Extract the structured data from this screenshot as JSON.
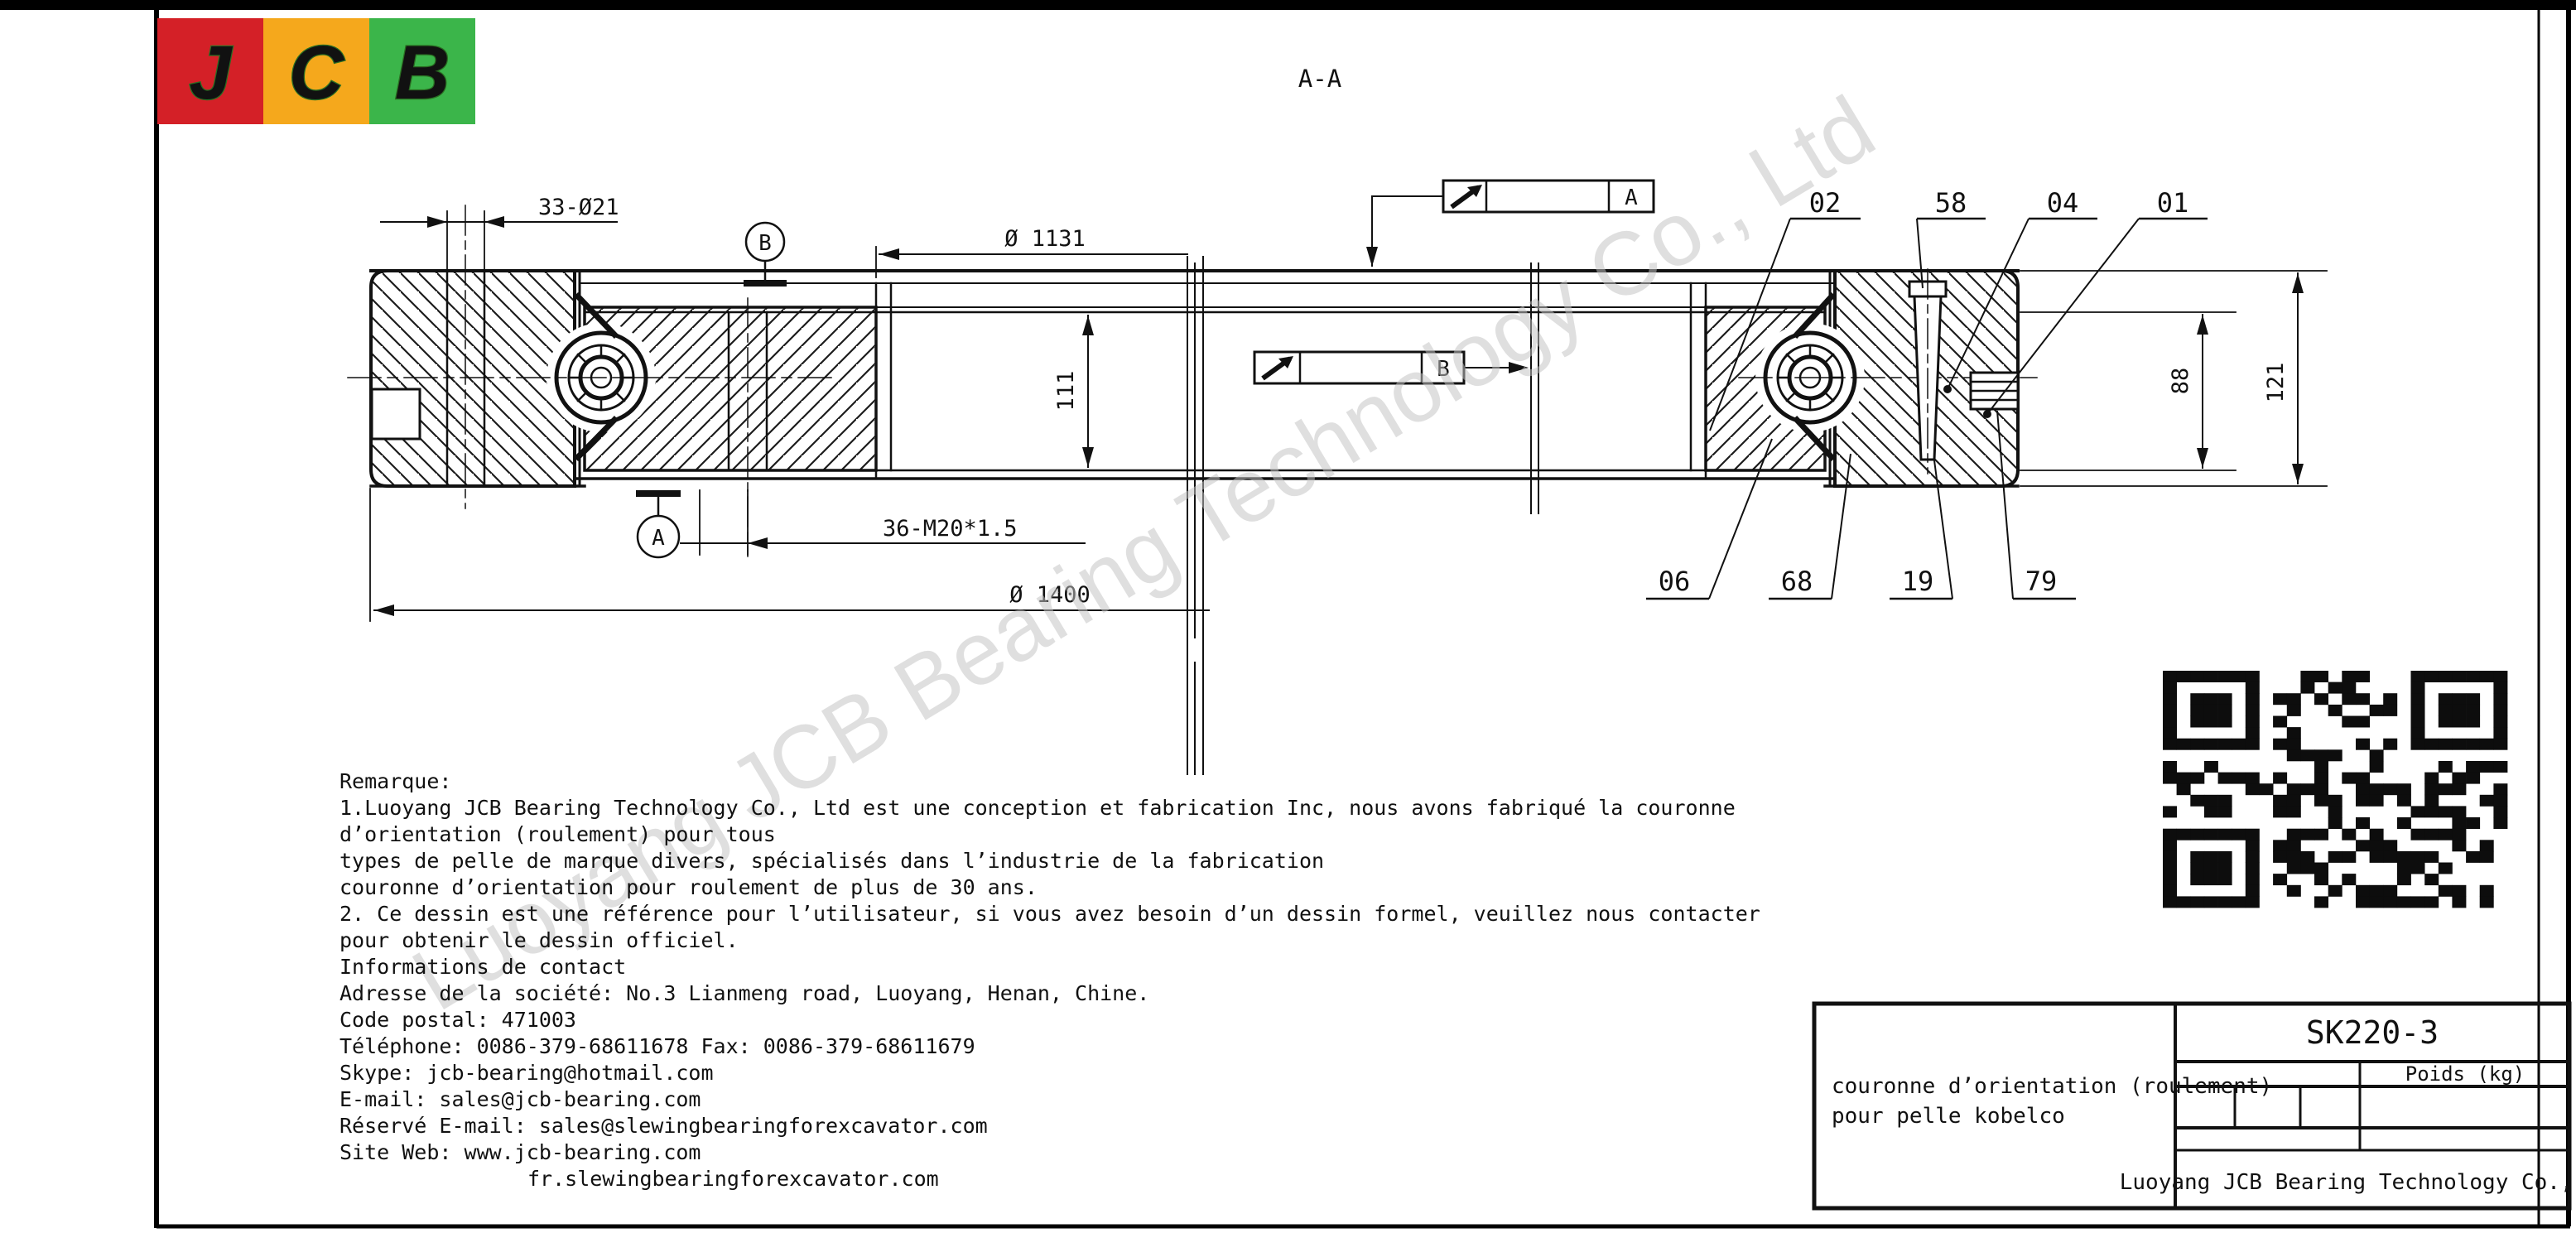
{
  "page": {
    "section_label": "A-A"
  },
  "logo": {
    "letters": [
      "J",
      "C",
      "B"
    ],
    "colors": {
      "red": "#d42027",
      "orange": "#f5a81c",
      "green": "#3bb54a",
      "letter": "#f2eb0a"
    }
  },
  "watermark": "Luoyang JCB Bearing Technology Co., Ltd",
  "drawing": {
    "dims": {
      "bolt_pattern_top": "33-Ø21",
      "bore_diameter": "Ø 1131",
      "bore_height": "111",
      "bolt_pattern_bottom": "36-M20*1.5",
      "outer_diameter": "Ø 1400",
      "inner_ring_height": "88",
      "total_height": "121"
    },
    "datums": {
      "a": "A",
      "b": "B"
    },
    "callouts_top": [
      "02",
      "58",
      "04",
      "01"
    ],
    "callouts_bottom": [
      "06",
      "68",
      "19",
      "79"
    ]
  },
  "notes": {
    "lines": [
      "Remarque:",
      "1.Luoyang JCB Bearing Technology Co., Ltd est une conception et fabrication Inc, nous avons fabriqué la couronne",
      "d’orientation (roulement) pour tous",
      "types de pelle de marque divers, spécialisés dans l’industrie de la fabrication",
      "couronne d’orientation pour roulement de plus de 30 ans.",
      "2. Ce dessin est une référence pour l’utilisateur, si vous avez besoin d’un dessin formel, veuillez nous contacter",
      "pour obtenir le dessin officiel.",
      "Informations de contact",
      "Adresse de la société: No.3 Lianmeng road, Luoyang, Henan, Chine.",
      "Code postal: 471003",
      "Téléphone: 0086-379-68611678 Fax: 0086-379-68611679",
      "Skype: jcb-bearing@hotmail.com",
      "E-mail: sales@jcb-bearing.com",
      "Réservé E-mail: sales@slewingbearingforexcavator.com",
      "Site Web: www.jcb-bearing.com",
      "fr.slewingbearingforexcavator.com"
    ]
  },
  "title_block": {
    "part_number": "SK220-3",
    "weight_label": "Poids (kg)",
    "description_line1": "couronne d’orientation (roulement)",
    "description_line2": "pour pelle kobelco",
    "company": "Luoyang JCB Bearing Technology Co., Ltd"
  }
}
